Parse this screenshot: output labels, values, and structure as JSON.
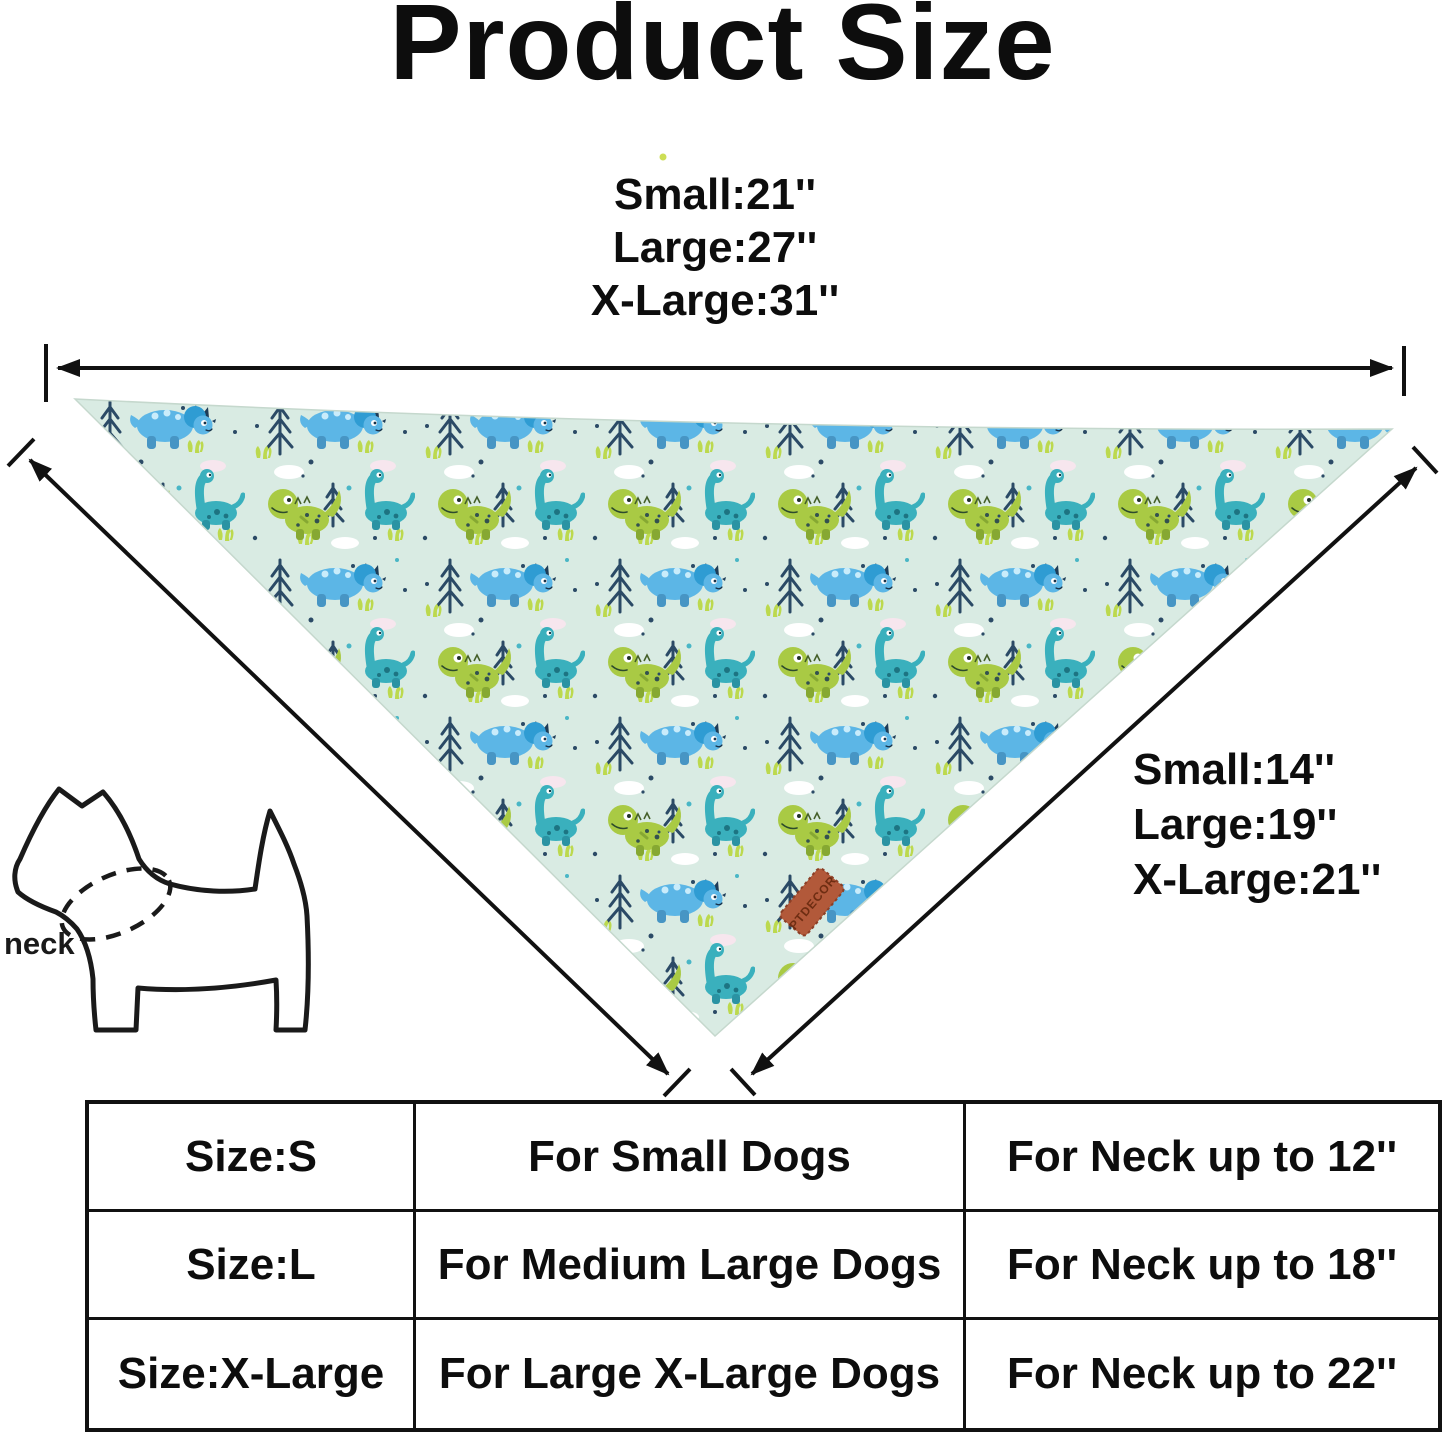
{
  "title": "Product Size",
  "flat_measurements": {
    "lines": [
      "Small:21''",
      "Large:27''",
      "X-Large:31''"
    ]
  },
  "side_measurements": {
    "lines": [
      "Small:14''",
      "Large:19''",
      "X-Large:21''"
    ]
  },
  "dog_diagram": {
    "neck_label": "neck"
  },
  "bandana": {
    "tag_text": "PTDECOR",
    "base_color": "#d9ebe3",
    "pattern_motifs": [
      "blue-triceratops",
      "teal-brontosaurus",
      "green-trex",
      "navy-pine-tree",
      "cloud",
      "grass-tuft"
    ]
  },
  "size_table": {
    "rows": [
      {
        "size": "Size:S",
        "dog": "For Small Dogs",
        "neck": "For Neck up to 12''"
      },
      {
        "size": "Size:L",
        "dog": "For Medium Large Dogs",
        "neck": "For Neck up to 18''"
      },
      {
        "size": "Size:X-Large",
        "dog": "For Large X-Large Dogs",
        "neck": "For Neck up to 22''"
      }
    ]
  }
}
